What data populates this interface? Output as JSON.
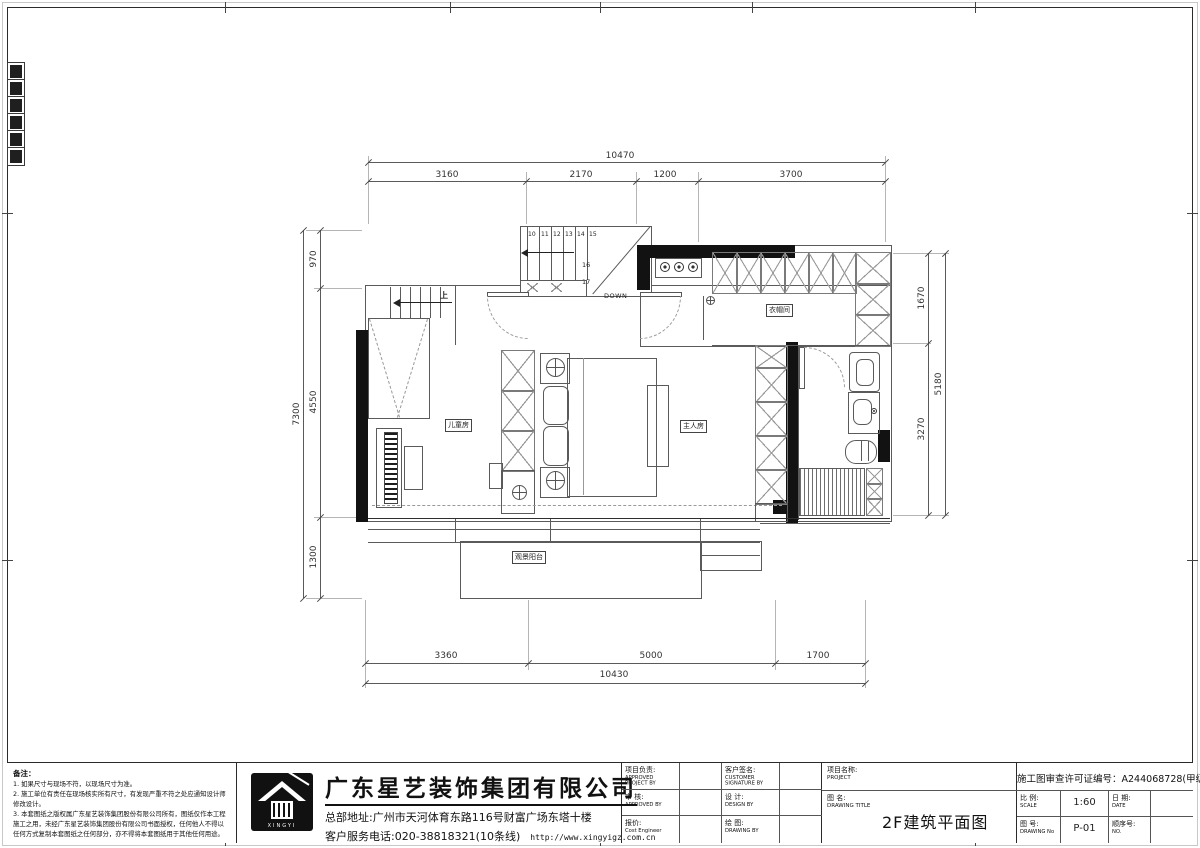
{
  "plan": {
    "dims": {
      "top": {
        "total": "10470",
        "segments": [
          "3160",
          "2170",
          "1200",
          "3700"
        ]
      },
      "bottom": {
        "total": "10430",
        "segments": [
          "3360",
          "5000",
          "1700"
        ]
      },
      "left": {
        "total": "7300",
        "segments": [
          "970",
          "4550",
          "1300"
        ]
      },
      "right": {
        "total": "5180",
        "segments": [
          "1670",
          "3270"
        ]
      }
    },
    "stair": {
      "treads": [
        "10",
        "11",
        "12",
        "13",
        "14",
        "15"
      ],
      "t16": "16",
      "t17": "17",
      "down_label": "DOWN",
      "up_label": "上"
    },
    "rooms": {
      "children": "儿童房",
      "master": "主人房",
      "cloak": "衣帽间",
      "balcony": "观景阳台"
    }
  },
  "notes": {
    "title": "备注：",
    "lines": [
      "1. 如果尺寸与现场不符，以现场尺寸为准。",
      "2. 施工单位有责任在现场核实所有尺寸，有发现严重不符之处应通知设计师修改设计。",
      "3. 本套图纸之版权属广东星艺装饰集团股份有限公司所有，图纸仅作本工程施工之用，未经广东星艺装饰集团股份有限公司书面授权，任何他人不得以任何方式复制本套图纸之任何部分，亦不得将本套图纸用于其他任何用途。"
    ]
  },
  "company": {
    "name": "广东星艺装饰集团有限公司",
    "address": "总部地址:广州市天河体育东路116号财富广场东塔十楼",
    "phone": "客户服务电话:020-38818321(10条线)",
    "website": "http://www.xingyigz.com.cn",
    "logo_caption": "XINGYI"
  },
  "signatures": [
    {
      "cn": "项目负责:",
      "en": "APPROVED PROJECT BY"
    },
    {
      "cn": "客户签名:",
      "en": "CUSTOMER SIGNATURE BY"
    },
    {
      "cn": "审 核:",
      "en": "APPROVED BY"
    },
    {
      "cn": "设 计:",
      "en": "DESIGN BY"
    },
    {
      "cn": "报价:",
      "en": "Cost Engineer"
    },
    {
      "cn": "绘 图:",
      "en": "DRAWING BY"
    }
  ],
  "titleblock": {
    "project_cn": "项目名称:",
    "project_en": "PROJECT",
    "drawing_cn": "图 名:",
    "drawing_en": "DRAWING TITLE",
    "drawing_title": "2F建筑平面图",
    "license_label": "施工图审查许可证编号：",
    "license_value": "A244068728(甲级)",
    "scale_cn": "比 例:",
    "scale_en": "SCALE",
    "scale_value": "1:60",
    "date_cn": "日 期:",
    "date_en": "DATE",
    "no_cn": "图 号:",
    "no_en": "DRAWING No",
    "no_value": "P-01",
    "seq_cn": "顺序号:",
    "seq_en": "NO."
  }
}
